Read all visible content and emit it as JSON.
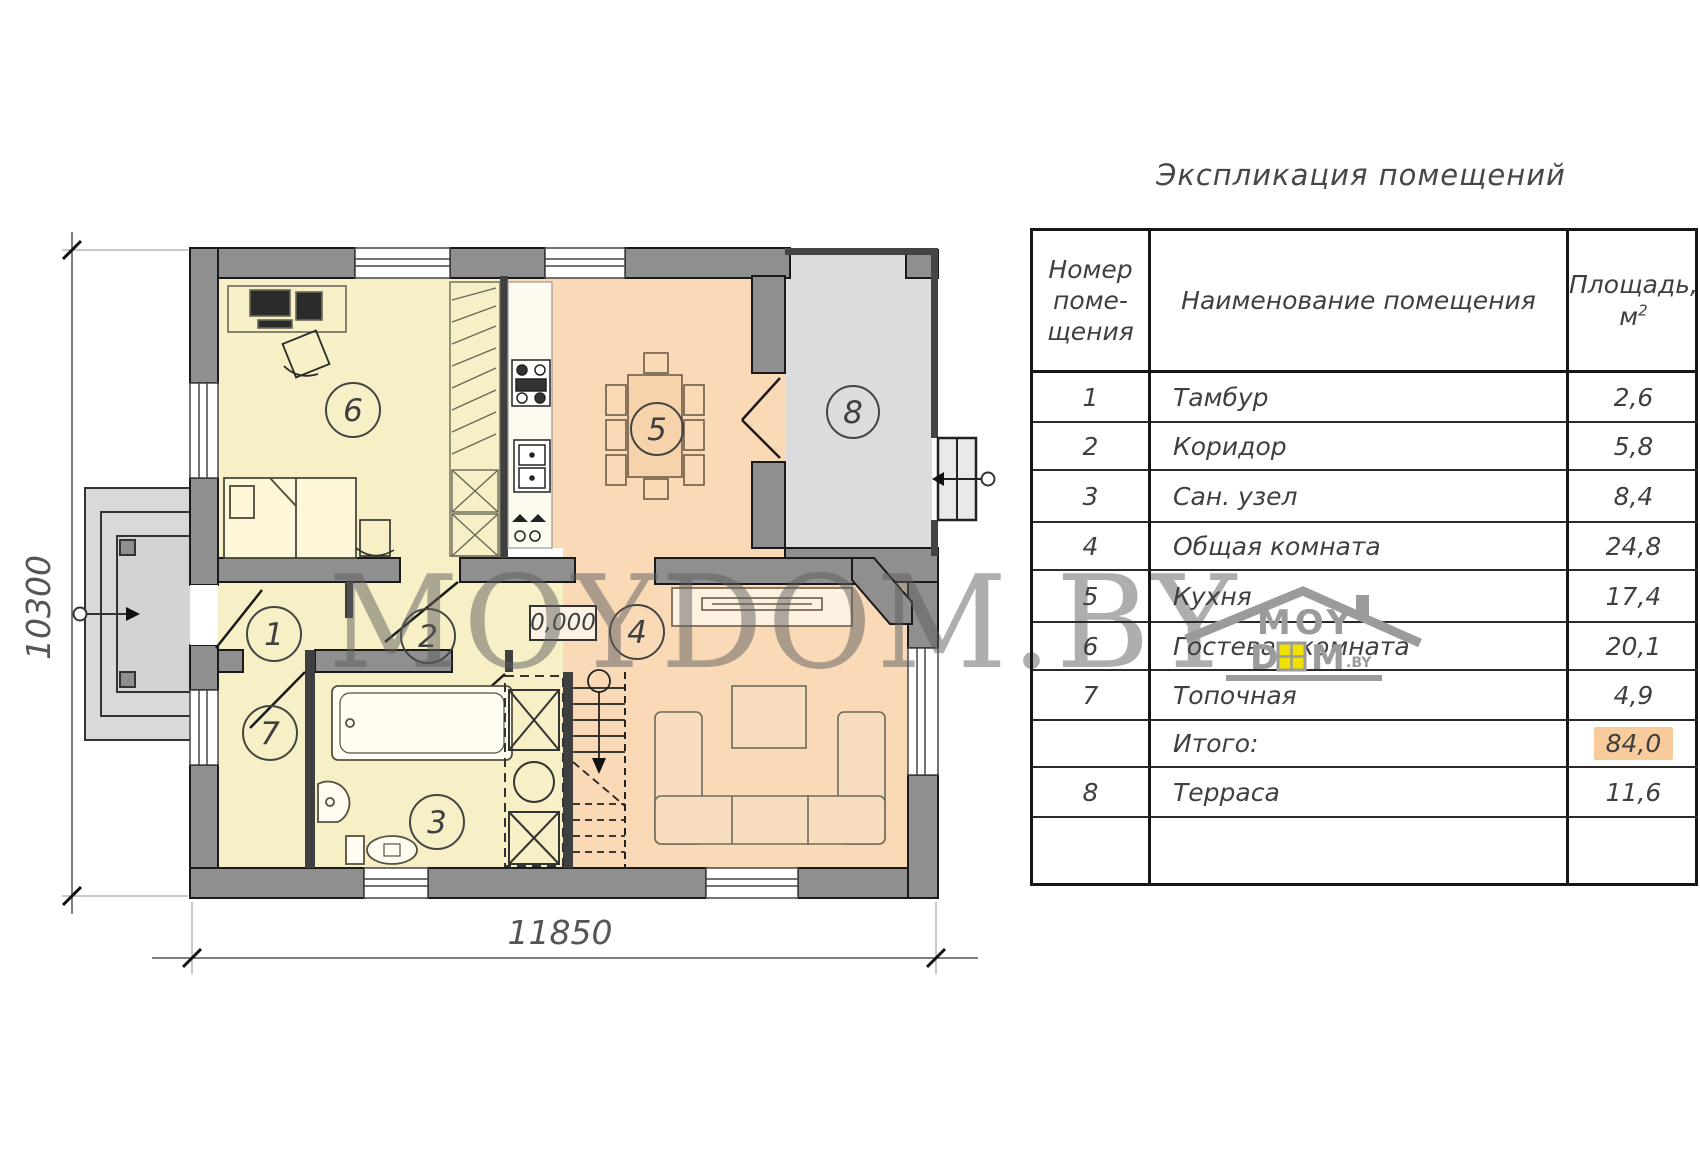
{
  "plan": {
    "dimensions": {
      "width_label": "11850",
      "height_label": "10300"
    },
    "level_marker": "0,000",
    "room_numbers": [
      "1",
      "2",
      "3",
      "4",
      "5",
      "6",
      "7",
      "8"
    ],
    "colors": {
      "room_yellow": "#f7efc6",
      "room_orange": "#f9d9b6",
      "terrace_gray": "#dcdcdc",
      "wall_gray": "#8f8f8f",
      "highlight_orange": "#f7cb9b"
    }
  },
  "watermark": {
    "text": "MOYDOM.BY"
  },
  "logo": {
    "top": "MOY",
    "d": "D",
    "m": "M",
    "suffix": ".BY"
  },
  "table": {
    "title": "Экспликация помещений",
    "header": {
      "col1_line1": "Номер",
      "col1_line2": "поме-",
      "col1_line3": "щения",
      "col2": "Наименование помещения",
      "col3_line1": "Площадь,",
      "col3_unit": "м",
      "col3_sup": "2"
    },
    "rows": [
      {
        "number": "1",
        "name": "Тамбур",
        "area": "2,6"
      },
      {
        "number": "2",
        "name": "Коридор",
        "area": "5,8"
      },
      {
        "number": "3",
        "name": "Сан. узел",
        "area": "8,4"
      },
      {
        "number": "4",
        "name": "Общая комната",
        "area": "24,8"
      },
      {
        "number": "5",
        "name": "Кухня",
        "area": "17,4"
      },
      {
        "number": "6",
        "name": "Гостевая комната",
        "area": "20,1"
      },
      {
        "number": "7",
        "name": "Топочная",
        "area": "4,9"
      },
      {
        "number": "",
        "name": "Итого:",
        "area": "84,0"
      },
      {
        "number": "8",
        "name": "Терраса",
        "area": "11,6"
      },
      {
        "number": "",
        "name": "",
        "area": ""
      }
    ]
  }
}
